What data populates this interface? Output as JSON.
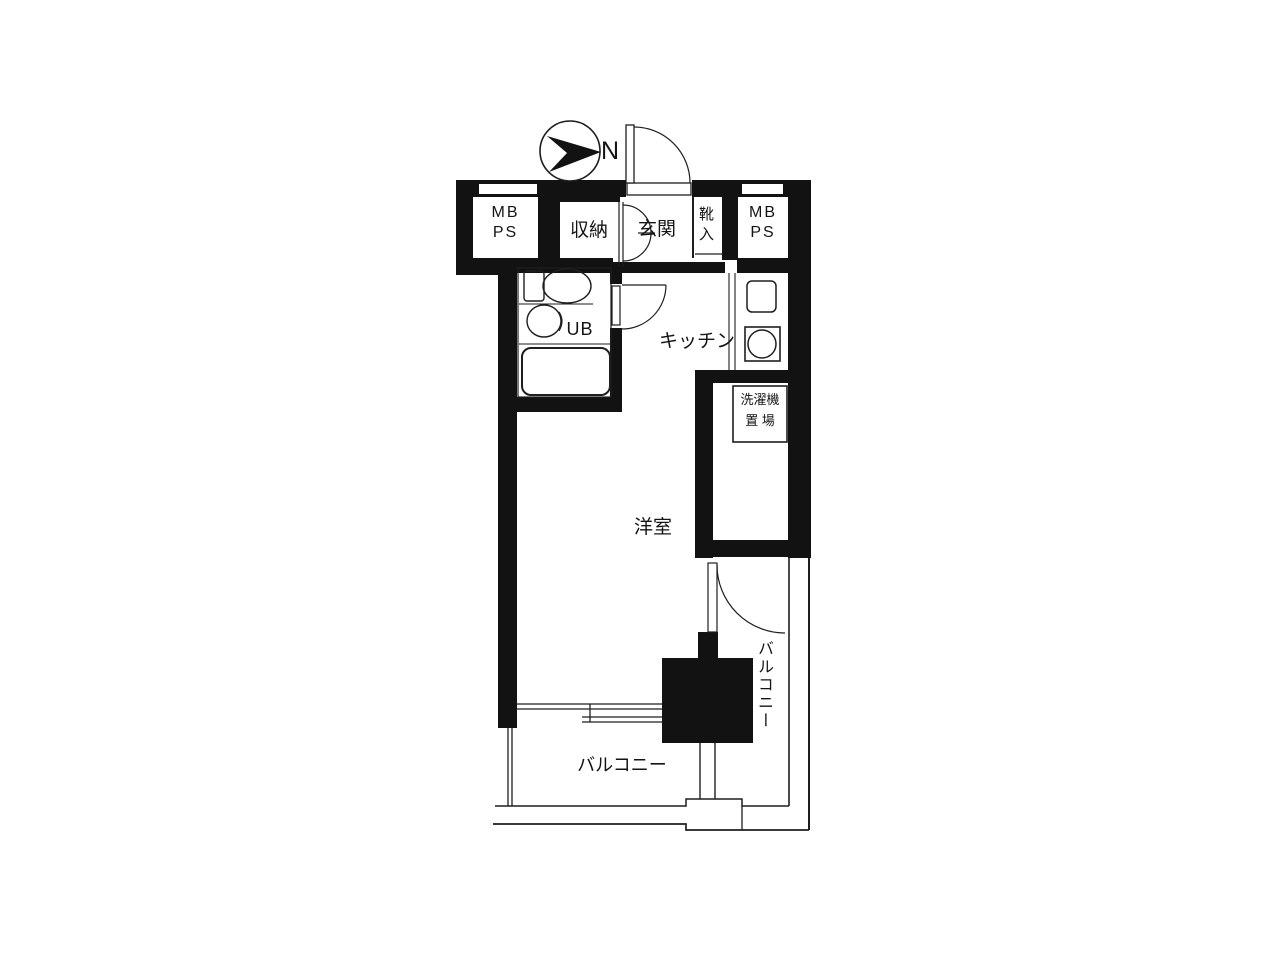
{
  "title": "apartment-floor-plan",
  "compass": {
    "label": "N",
    "direction": "arrow-points-right"
  },
  "rooms": {
    "mb_ps_left": "MB\nPS",
    "closet": "収納",
    "entrance": "玄関",
    "shoe_cabinet": "靴入",
    "mb_ps_right": "MB\nPS",
    "unit_bath": "UB",
    "kitchen": "キッチン",
    "washer_space": "洗濯機\n置 場",
    "western_room": "洋室",
    "balcony_right": "バルコニー",
    "balcony_bottom": "バルコニー"
  },
  "colors": {
    "background": "#ffffff",
    "wall": "#121212",
    "line": "#1e1e1e"
  }
}
